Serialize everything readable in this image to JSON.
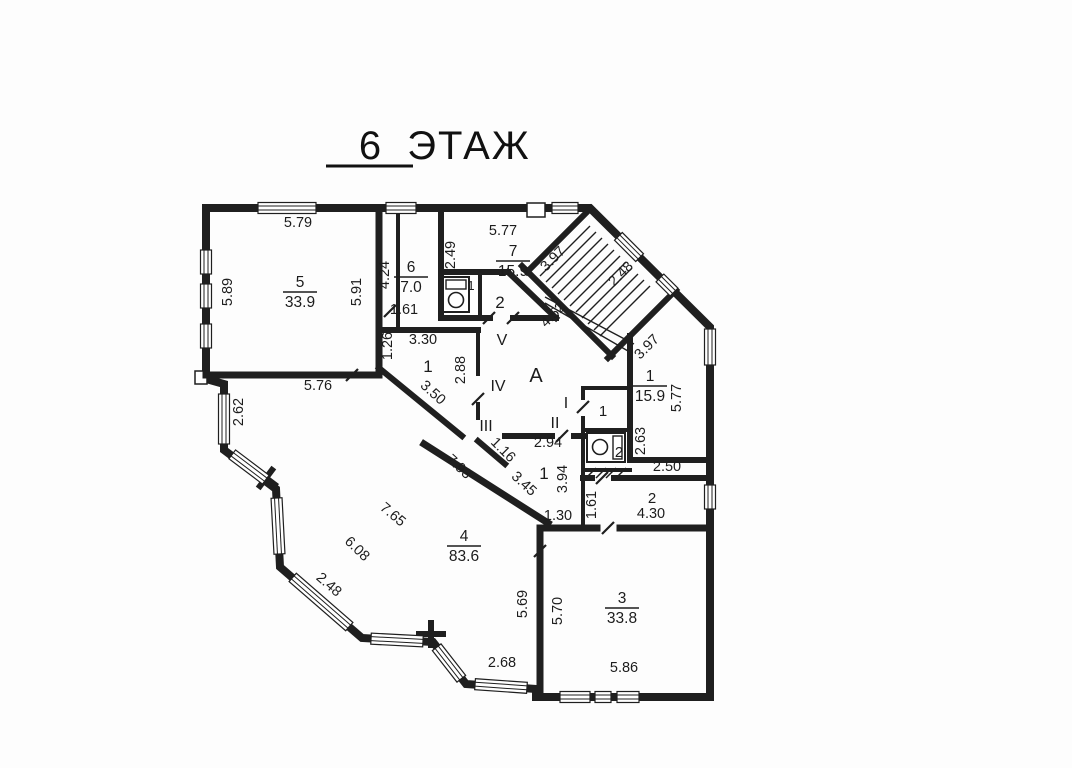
{
  "title": {
    "floor_number": "6",
    "floor_word": "ЭТАЖ"
  },
  "plan": {
    "room_labels": [
      {
        "name": "room-5",
        "number": "5",
        "area": "33.9",
        "x": 300,
        "y": 292
      },
      {
        "name": "room-6",
        "number": "6",
        "area": "7.0",
        "x": 411,
        "y": 277
      },
      {
        "name": "room-7",
        "number": "7",
        "area": "15.9",
        "x": 513,
        "y": 261
      },
      {
        "name": "room-1-right",
        "number": "1",
        "area": "15.9",
        "x": 650,
        "y": 386
      },
      {
        "name": "room-4",
        "number": "4",
        "area": "83.6",
        "x": 464,
        "y": 546
      },
      {
        "name": "room-3",
        "number": "3",
        "area": "33.8",
        "x": 622,
        "y": 608
      }
    ],
    "zone_labels": [
      {
        "name": "zone-A",
        "text": "А",
        "x": 536,
        "y": 382,
        "fs": 20
      },
      {
        "name": "zone-V",
        "text": "V",
        "x": 502,
        "y": 345,
        "fs": 16
      },
      {
        "name": "zone-IV",
        "text": "IV",
        "x": 498,
        "y": 391,
        "fs": 16
      },
      {
        "name": "zone-III",
        "text": "III",
        "x": 486,
        "y": 431,
        "fs": 16
      },
      {
        "name": "zone-I",
        "text": "I",
        "x": 566,
        "y": 408,
        "fs": 16
      },
      {
        "name": "zone-II",
        "text": "II",
        "x": 555,
        "y": 428,
        "fs": 16
      },
      {
        "name": "hall-top-1",
        "text": "1",
        "x": 428,
        "y": 372,
        "fs": 17
      },
      {
        "name": "hall-center-1",
        "text": "1",
        "x": 544,
        "y": 479,
        "fs": 17
      },
      {
        "name": "lobby-1",
        "text": "1",
        "x": 603,
        "y": 416,
        "fs": 15
      },
      {
        "name": "wc-top-1",
        "text": "1",
        "x": 471,
        "y": 290,
        "fs": 13
      },
      {
        "name": "wc-top-room-2",
        "text": "2",
        "x": 500,
        "y": 308,
        "fs": 17
      },
      {
        "name": "wc2-2",
        "text": "2",
        "x": 619,
        "y": 457,
        "fs": 15
      },
      {
        "name": "room-2-right",
        "text": "2",
        "x": 652,
        "y": 503,
        "fs": 15
      }
    ],
    "dimension_labels": [
      {
        "text": "5.79",
        "x": 298,
        "y": 227,
        "rot": 0
      },
      {
        "text": "5.89",
        "x": 232,
        "y": 292,
        "rot": -90
      },
      {
        "text": "5.91",
        "x": 361,
        "y": 292,
        "rot": -90
      },
      {
        "text": "5.76",
        "x": 318,
        "y": 390,
        "rot": 0
      },
      {
        "text": "2.62",
        "x": 243,
        "y": 412,
        "rot": -90
      },
      {
        "text": "4.24",
        "x": 389,
        "y": 275,
        "rot": -90
      },
      {
        "text": "1.61",
        "x": 404,
        "y": 314,
        "rot": 0
      },
      {
        "text": "2.49",
        "x": 455,
        "y": 255,
        "rot": -90
      },
      {
        "text": "5.77",
        "x": 503,
        "y": 235,
        "rot": 0
      },
      {
        "text": "3.97",
        "x": 556,
        "y": 262,
        "rot": -45
      },
      {
        "text": "2.48",
        "x": 624,
        "y": 277,
        "rot": -45
      },
      {
        "text": "4.52",
        "x": 556,
        "y": 318,
        "rot": -45
      },
      {
        "text": "3.97",
        "x": 650,
        "y": 350,
        "rot": -45
      },
      {
        "text": "5.77",
        "x": 681,
        "y": 398,
        "rot": -90
      },
      {
        "text": "2.63",
        "x": 645,
        "y": 441,
        "rot": -90
      },
      {
        "text": "2.50",
        "x": 667,
        "y": 471,
        "rot": 0
      },
      {
        "text": "1.61",
        "x": 596,
        "y": 505,
        "rot": -90
      },
      {
        "text": "4.30",
        "x": 651,
        "y": 518,
        "rot": 0
      },
      {
        "text": "1.26",
        "x": 392,
        "y": 346,
        "rot": -90
      },
      {
        "text": "3.30",
        "x": 423,
        "y": 344,
        "rot": 0
      },
      {
        "text": "2.88",
        "x": 465,
        "y": 370,
        "rot": -90
      },
      {
        "text": "3.50",
        "x": 430,
        "y": 396,
        "rot": 42
      },
      {
        "text": "7.93",
        "x": 456,
        "y": 470,
        "rot": 43
      },
      {
        "text": "1.16",
        "x": 500,
        "y": 453,
        "rot": 45
      },
      {
        "text": "2.94",
        "x": 548,
        "y": 447,
        "rot": 0
      },
      {
        "text": "3.45",
        "x": 521,
        "y": 487,
        "rot": 43
      },
      {
        "text": "3.94",
        "x": 567,
        "y": 479,
        "rot": -90
      },
      {
        "text": "1.30",
        "x": 558,
        "y": 520,
        "rot": 0
      },
      {
        "text": "7.65",
        "x": 390,
        "y": 518,
        "rot": 40
      },
      {
        "text": "6.08",
        "x": 354,
        "y": 552,
        "rot": 44
      },
      {
        "text": "2.48",
        "x": 326,
        "y": 588,
        "rot": 41
      },
      {
        "text": "2.68",
        "x": 502,
        "y": 667,
        "rot": 0
      },
      {
        "text": "5.69",
        "x": 527,
        "y": 604,
        "rot": -90
      },
      {
        "text": "5.70",
        "x": 562,
        "y": 611,
        "rot": -90
      },
      {
        "text": "5.86",
        "x": 624,
        "y": 672,
        "rot": 0
      }
    ]
  }
}
